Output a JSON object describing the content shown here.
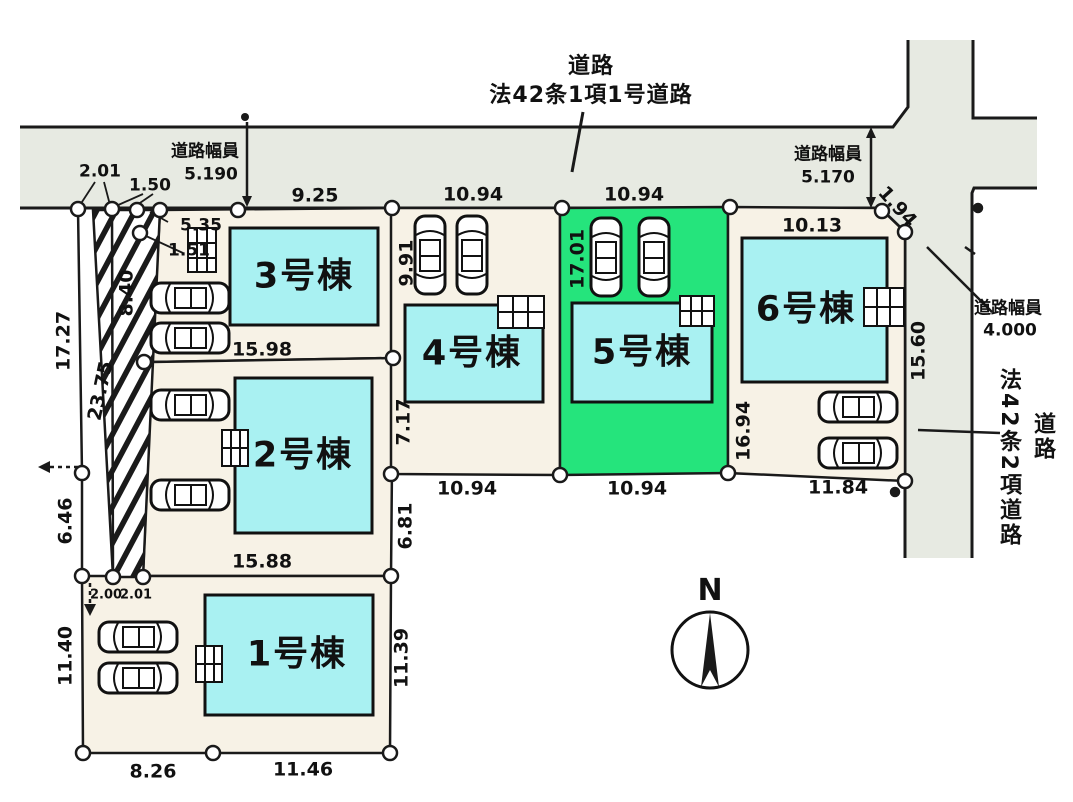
{
  "top_road": {
    "line1": "道路",
    "line2": "法42条1項1号道路"
  },
  "side_road": {
    "line1": "道路",
    "line2": "法42条2項道路"
  },
  "road_widths": {
    "left": {
      "label": "道路幅員",
      "value": "5.190"
    },
    "center": {
      "label": "道路幅員",
      "value": "5.170"
    },
    "right": {
      "label": "道路幅員",
      "value": "4.000"
    }
  },
  "lots": [
    {
      "building": "1号棟",
      "highlighted": false
    },
    {
      "building": "2号棟",
      "highlighted": false
    },
    {
      "building": "3号棟",
      "highlighted": false
    },
    {
      "building": "4号棟",
      "highlighted": false
    },
    {
      "building": "5号棟",
      "highlighted": true
    },
    {
      "building": "6号棟",
      "highlighted": false
    }
  ],
  "dims": {
    "t2_01": "2.01",
    "t1_50": "1.50",
    "t9_25": "9.25",
    "t10_94a": "10.94",
    "t10_94b": "10.94",
    "t10_13": "10.13",
    "d1_94": "1.94",
    "l5_35": "5.35",
    "l1_51": "1.51",
    "l8_40": "8.40",
    "l17_27": "17.27",
    "l23_75": "23.75",
    "l6_46": "6.46",
    "m15_98": "15.98",
    "m15_88": "15.88",
    "r9_91": "9.91",
    "r7_17": "7.17",
    "r6_81": "6.81",
    "c17_01": "17.01",
    "c16_94": "16.94",
    "c15_60": "15.60",
    "b2_00": "2.00",
    "b2_01": "2.01",
    "b11_40": "11.40",
    "b11_39": "11.39",
    "b8_26": "8.26",
    "b11_46": "11.46",
    "b10_94a": "10.94",
    "b10_94b": "10.94",
    "b11_84": "11.84"
  },
  "compass": {
    "label": "N"
  },
  "colors": {
    "road_gray": "#e7eae2",
    "lot_beige": "#f7f2e6",
    "highlight_green": "#25e47c",
    "building_cyan": "#a9f1f2",
    "line_black": "#1a1a1a"
  }
}
